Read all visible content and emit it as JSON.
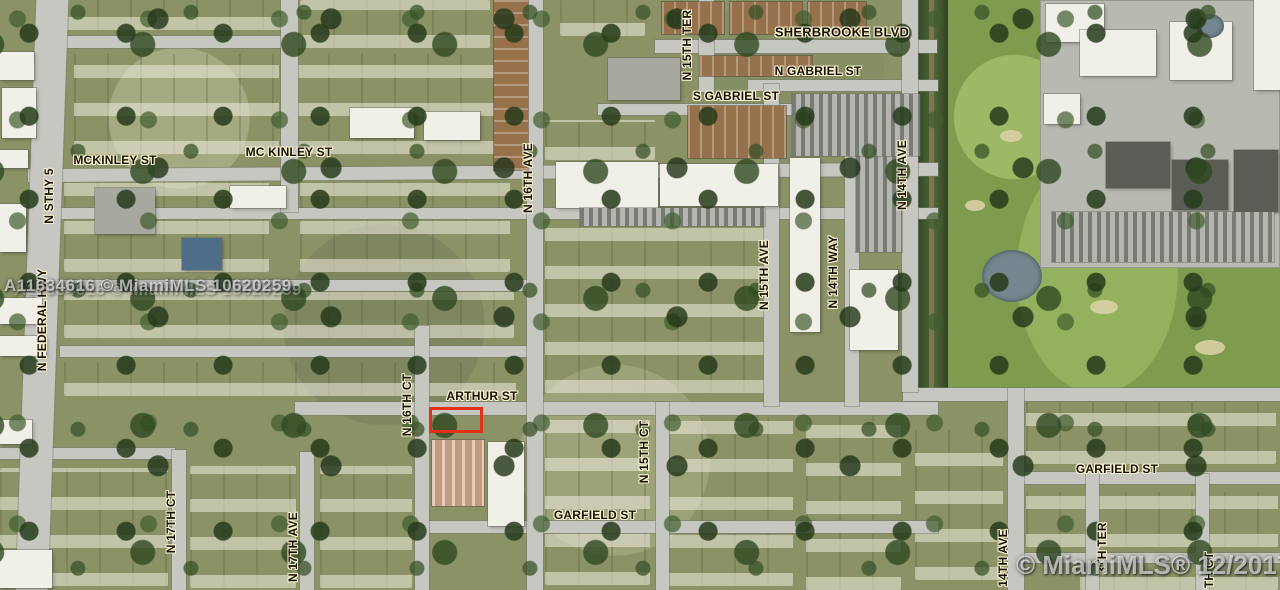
{
  "map": {
    "description": "Aerial MLS parcel map, Hollywood FL area",
    "street_labels": {
      "sherbrooke_blvd": "SHERBROOKE BLVD",
      "n_gabriel_st": "N GABRIEL ST",
      "s_gabriel_st": "S GABRIEL ST",
      "mckinley_st_west": "MCKINLEY ST",
      "mckinley_st_east": "MC KINLEY ST",
      "arthur_st": "ARTHUR ST",
      "garfield_st_center": "GARFIELD ST",
      "garfield_st_east": "GARFIELD ST",
      "n_sthy_5": "N STHY 5",
      "n_federal_hwy": "N FEDERAL HWY",
      "n_15th_ter": "N 15TH TER",
      "n_16th_ave": "N 16TH AVE",
      "n_16th_ct": "N 16TH CT",
      "n_15th_ave": "N 15TH AVE",
      "n_15th_ct": "N 15TH CT",
      "n_14th_way": "N 14TH WAY",
      "n_14th_ave": "N 14TH AVE",
      "n_17th_ct": "N 17TH CT",
      "n_17th_ave": "N 17TH AVE",
      "s_14th_ave_partial": "14TH AVE",
      "n_13th_ter_partial": "3TH TER",
      "n_13th_ct_partial": "TH CT"
    },
    "watermarks": {
      "listing_overlay": "A11634616 © MiamiMLS 10620259",
      "brand_date": "© MiamiMLS® 12/2017"
    },
    "highlight_color": "#e2301a"
  }
}
